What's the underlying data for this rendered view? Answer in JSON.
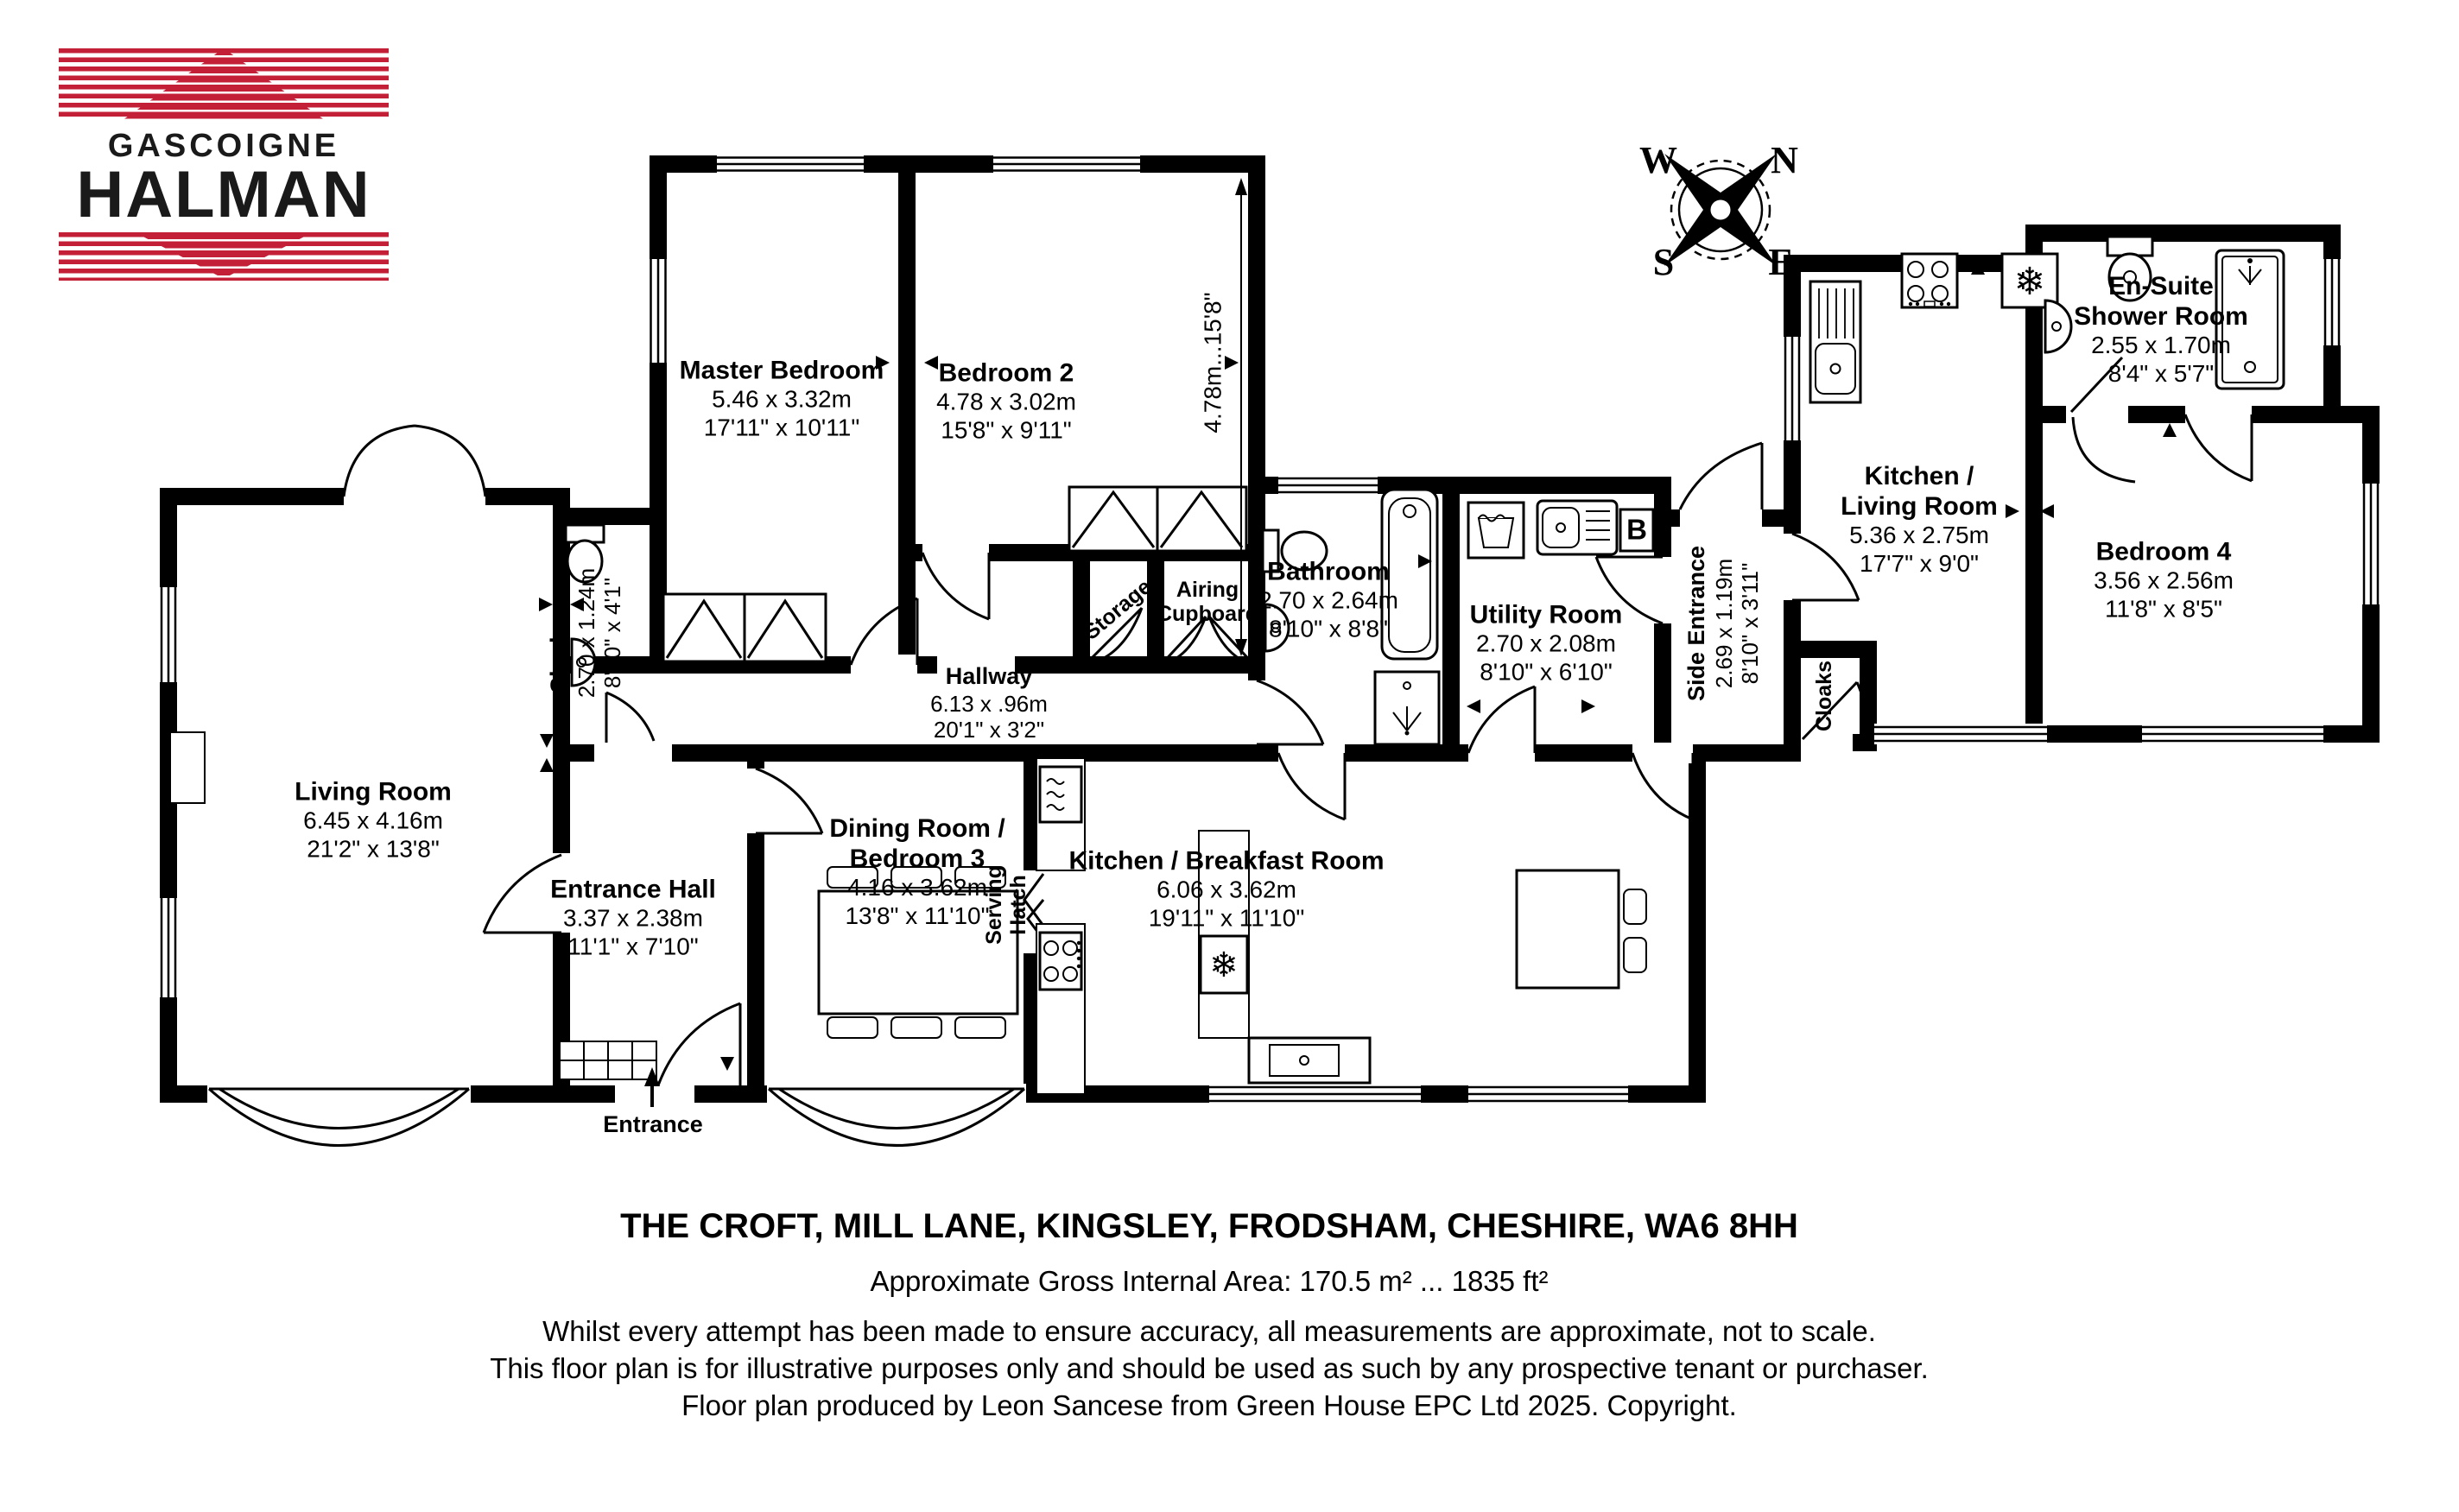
{
  "brand": {
    "logo_line1": "GASCOIGNE",
    "logo_line2": "HALMAN",
    "red": "#c32038"
  },
  "compass": {
    "north": "N",
    "south": "S",
    "east": "E",
    "west": "W"
  },
  "rooms": [
    {
      "id": "master-bedroom",
      "name": "Master Bedroom",
      "metric": "5.46 x 3.32m",
      "imperial": "17'11\" x 10'11\""
    },
    {
      "id": "bedroom-2",
      "name": "Bedroom 2",
      "metric": "4.78 x 3.02m",
      "imperial": "15'8\" x 9'11\""
    },
    {
      "id": "bathroom",
      "name": "Bathroom",
      "metric": "2.70 x 2.64m",
      "imperial": "8'10\" x 8'8\""
    },
    {
      "id": "utility-room",
      "name": "Utility Room",
      "metric": "2.70 x 2.08m",
      "imperial": "8'10\" x 6'10\""
    },
    {
      "id": "living-room",
      "name": "Living Room",
      "metric": "6.45 x 4.16m",
      "imperial": "21'2\" x 13'8\""
    },
    {
      "id": "entrance-hall",
      "name": "Entrance Hall",
      "metric": "3.37 x 2.38m",
      "imperial": "11'1\" x 7'10\""
    },
    {
      "id": "hallway",
      "name": "Hallway",
      "metric": "6.13 x .96m",
      "imperial": "20'1\" x 3'2\""
    },
    {
      "id": "dining-room-bedroom-3",
      "name": "Dining Room / Bedroom 3",
      "metric": "4.16 x 3.62m",
      "imperial": "13'8\" x 11'10\""
    },
    {
      "id": "kitchen-breakfast-room",
      "name": "Kitchen / Breakfast Room",
      "metric": "6.06 x 3.62m",
      "imperial": "19'11\" x 11'10\""
    },
    {
      "id": "kitchen-living-room",
      "name": "Kitchen / Living Room",
      "metric": "5.36 x 2.75m",
      "imperial": "17'7\" x 9'0\""
    },
    {
      "id": "en-suite-shower-room",
      "name": "En-Suite Shower Room",
      "metric": "2.55 x 1.70m",
      "imperial": "8'4\" x 5'7\""
    },
    {
      "id": "bedroom-4",
      "name": "Bedroom 4",
      "metric": "3.56 x 2.56m",
      "imperial": "11'8\" x 8'5\""
    },
    {
      "id": "cloakroom",
      "name": "Cloakroom",
      "metric": "2.70 x 1.24m",
      "imperial": "8'10\" x 4'1\""
    },
    {
      "id": "side-entrance",
      "name": "Side Entrance",
      "metric": "2.69 x 1.19m",
      "imperial": "8'10\" x 3'11\""
    }
  ],
  "features": {
    "storage": "Storage",
    "airing_cupboard": "Airing Cupboard",
    "serving_hatch": "Serving Hatch",
    "cloaks": "Cloaks",
    "entrance": "Entrance",
    "boiler": "B",
    "bedroom2_length_dim": "4.78m...15'8\""
  },
  "footer": {
    "address": "THE CROFT, MILL LANE, KINGSLEY, FRODSHAM, CHESHIRE, WA6 8HH",
    "area": "Approximate Gross Internal Area: 170.5 m² ... 1835 ft²",
    "disclaimer1": "Whilst every attempt has been made to ensure accuracy, all measurements are approximate, not to scale.",
    "disclaimer2": "This floor plan is for illustrative purposes only and should be used as such by any prospective tenant or purchaser.",
    "credit": "Floor plan produced by Leon Sancese from Green House EPC Ltd 2025. Copyright."
  }
}
